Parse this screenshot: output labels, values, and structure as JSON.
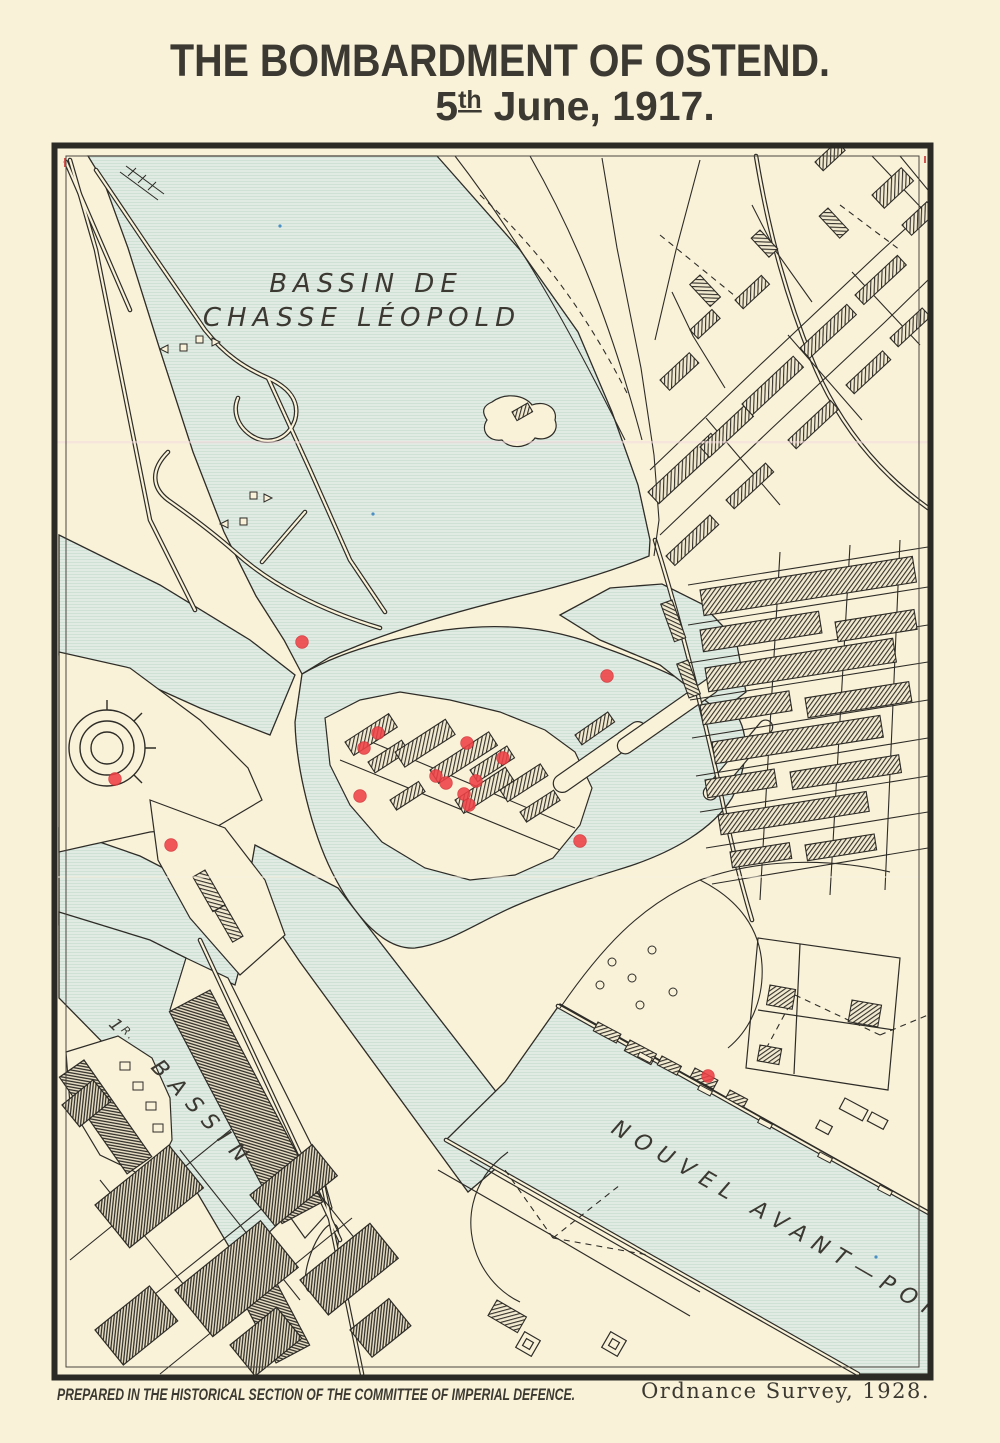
{
  "header": {
    "title": "THE BOMBARDMENT OF OSTEND.",
    "date_number": "5",
    "date_ordinal": "th",
    "date_rest": "June, 1917."
  },
  "map": {
    "labels": {
      "basin_line1": "BASSIN DE",
      "basin_line2": "CHASSE LÉOPOLD",
      "first_basin_number": "1",
      "first_basin_ordinal": "R.",
      "basin": "BASSIN",
      "avant_port": "NOUVEL AVANT—PORT"
    },
    "colors": {
      "paper": "#f9f2d9",
      "water": "#e1ebe3",
      "water_line": "#cddfd4",
      "ink": "#2e2c27",
      "title_ink": "#45423a",
      "impact_red": "#ef4146"
    },
    "impact_points": [
      {
        "x": 302,
        "y": 642
      },
      {
        "x": 607,
        "y": 676
      },
      {
        "x": 378,
        "y": 733
      },
      {
        "x": 364,
        "y": 748
      },
      {
        "x": 467,
        "y": 743
      },
      {
        "x": 503,
        "y": 758
      },
      {
        "x": 436,
        "y": 776
      },
      {
        "x": 446,
        "y": 783
      },
      {
        "x": 476,
        "y": 781
      },
      {
        "x": 464,
        "y": 794
      },
      {
        "x": 469,
        "y": 805
      },
      {
        "x": 360,
        "y": 796
      },
      {
        "x": 115,
        "y": 779
      },
      {
        "x": 171,
        "y": 845
      },
      {
        "x": 580,
        "y": 841
      },
      {
        "x": 708,
        "y": 1076
      }
    ]
  },
  "footer": {
    "prepared_by": "PREPARED IN THE HISTORICAL SECTION OF THE COMMITTEE OF IMPERIAL DEFENCE.",
    "source": "Ordnance Survey, 1928."
  }
}
